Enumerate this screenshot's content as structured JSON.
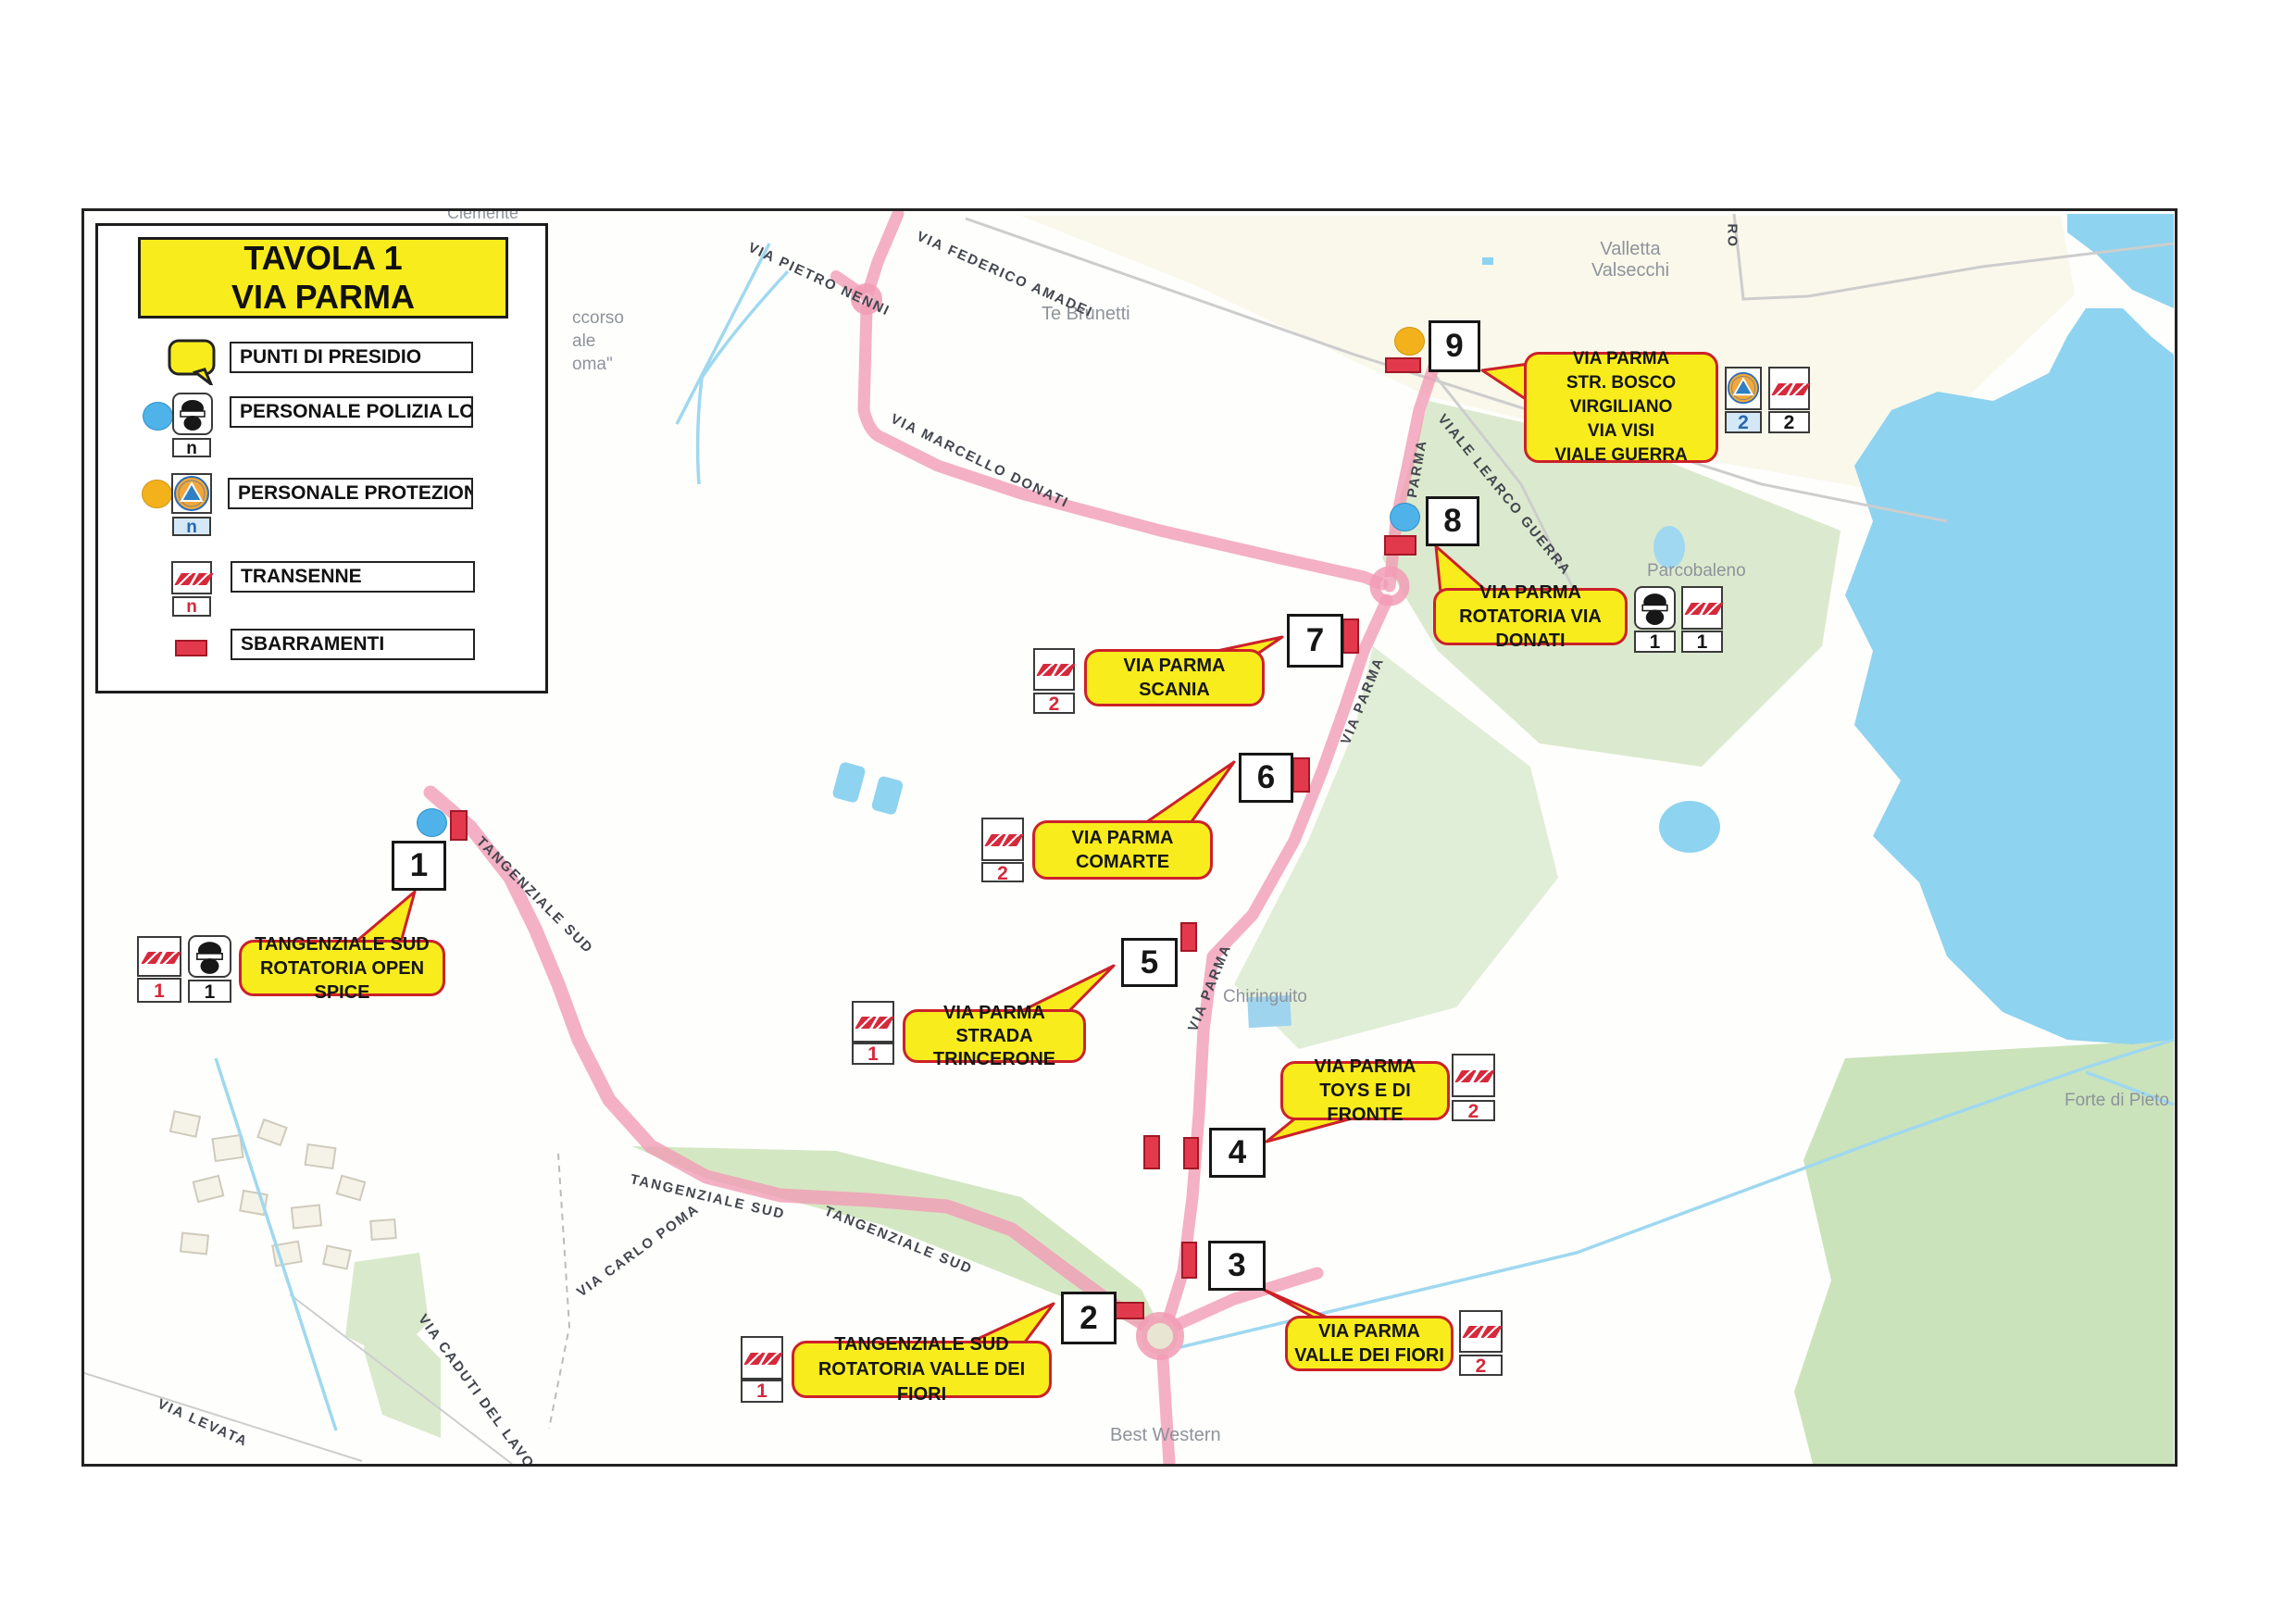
{
  "legend": {
    "title_lines": [
      "TAVOLA 1",
      "VIA PARMA"
    ],
    "items": [
      {
        "label": "PUNTI DI PRESIDIO"
      },
      {
        "label": "PERSONALE POLIZIA LOCALE",
        "count": "n"
      },
      {
        "label": "PERSONALE PROTEZIONE CIVILE",
        "count": "n"
      },
      {
        "label": "TRANSENNE",
        "count": "n"
      },
      {
        "label": "SBARRAMENTI"
      }
    ]
  },
  "points": {
    "p1": {
      "number": "1",
      "lines": [
        "TANGENZIALE SUD",
        "ROTATORIA OPEN SPICE"
      ],
      "transenne": "1",
      "polizia": "1"
    },
    "p2": {
      "number": "2",
      "lines": [
        "TANGENZIALE SUD",
        "ROTATORIA VALLE DEI FIORI"
      ],
      "transenne": "1"
    },
    "p3": {
      "number": "3",
      "lines": [
        "VIA PARMA",
        "VALLE DEI FIORI"
      ],
      "transenne": "2"
    },
    "p4": {
      "number": "4",
      "lines": [
        "VIA PARMA",
        "TOYS E DI FRONTE"
      ],
      "transenne": "2"
    },
    "p5": {
      "number": "5",
      "lines": [
        "VIA PARMA",
        "STRADA TRINCERONE"
      ],
      "transenne": "1"
    },
    "p6": {
      "number": "6",
      "lines": [
        "VIA PARMA",
        "COMARTE"
      ],
      "transenne": "2"
    },
    "p7": {
      "number": "7",
      "lines": [
        "VIA PARMA",
        "SCANIA"
      ],
      "transenne": "2"
    },
    "p8": {
      "number": "8",
      "lines": [
        "VIA PARMA",
        "ROTATORIA VIA DONATI"
      ],
      "polizia": "1",
      "transenne": "1"
    },
    "p9": {
      "number": "9",
      "lines": [
        "VIA PARMA",
        "STR. BOSCO VIRGILIANO",
        "VIA VISI",
        "VIALE GUERRA"
      ],
      "protezione": "2",
      "transenne": "2"
    }
  },
  "map_labels": {
    "places": {
      "te_brunetti": "Te Brunetti",
      "valletta_1": "Valletta",
      "valletta_2": "Valsecchi",
      "parcobaleno": "Parcobaleno",
      "chiringuito": "Chiringuito",
      "forte": "Forte di Pieto",
      "best_western": "Best Western",
      "clemente": "Clemente"
    },
    "streets": {
      "pietro_nenni": "VIA PIETRO NENNI",
      "federico_amadei": "VIA FEDERICO AMADEI",
      "marcello_donati": "VIA MARCELLO DONATI",
      "learco_guerra": "VIALE LEARCO GUERRA",
      "via_parma": "VIA PARMA",
      "tangenziale_sud": "TANGENZIALE SUD",
      "carlo_poma": "VIA CARLO POMA",
      "caduti_lavoro": "VIA CADUTI DEL LAVORO",
      "levata": "VIA LEVATA"
    },
    "partials": {
      "l1": "ccorso",
      "l2": "ale",
      "l3": "oma\"",
      "ro": "RO"
    }
  },
  "colors": {
    "callout_yellow": "#f8ec1c",
    "callout_border_red": "#cc2128",
    "bar_red": "#e23a4c",
    "stripe_red": "#d6293c",
    "police_blue": "#4fb2e8",
    "civil_yellow": "#f3b21c",
    "water_blue": "#8ed3f0",
    "road_pink": "#f19cb5",
    "green": "#d7e8c9"
  }
}
